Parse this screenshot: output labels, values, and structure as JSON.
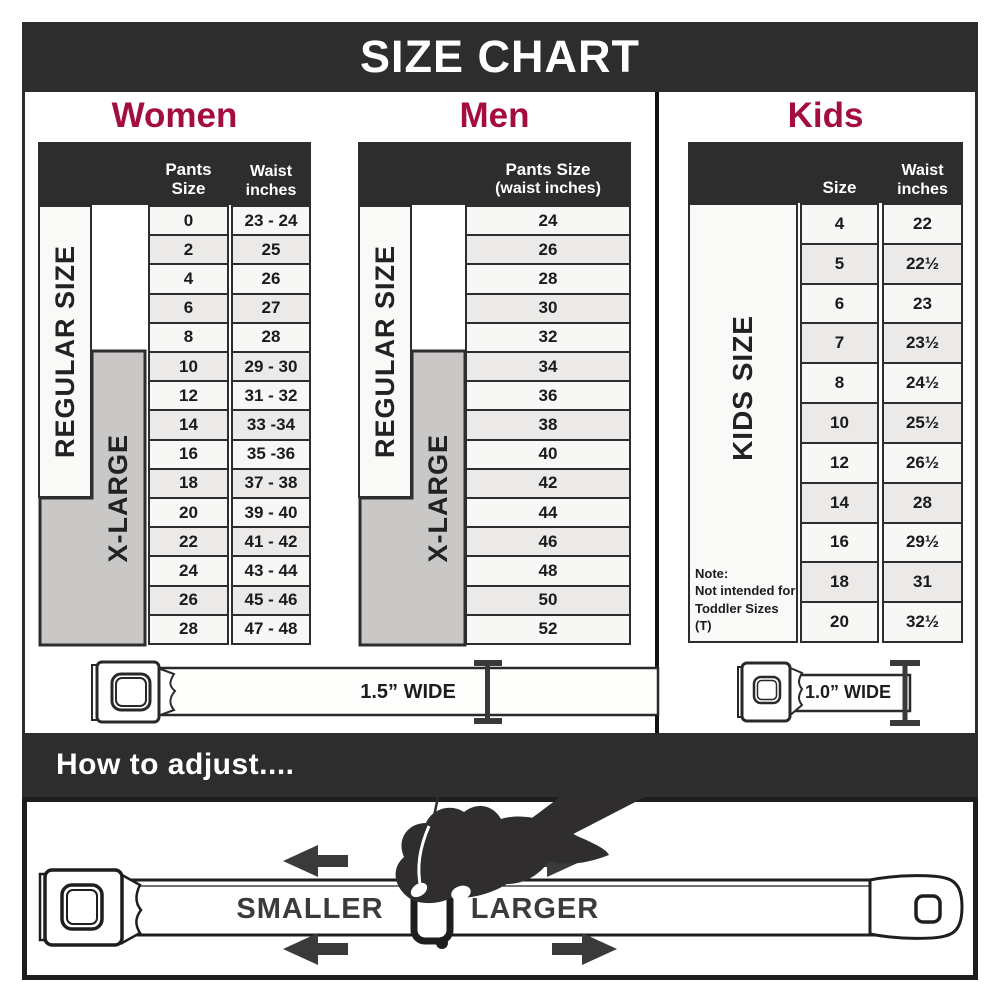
{
  "title": "SIZE CHART",
  "colors": {
    "dark": "#2e2d2e",
    "accent_crimson": "#a40e3e",
    "row_light": "#f7f7f5",
    "row_alt": "#eceae8",
    "xlarge_gray": "#c9c8c6"
  },
  "women": {
    "heading": "Women",
    "col1_header": "Pants Size",
    "col2_header_line1": "Waist",
    "col2_header_line2": "inches",
    "regular_label": "REGULAR SIZE",
    "xlarge_label": "X-LARGE",
    "rows": [
      {
        "size": "0",
        "waist": "23 - 24"
      },
      {
        "size": "2",
        "waist": "25"
      },
      {
        "size": "4",
        "waist": "26"
      },
      {
        "size": "6",
        "waist": "27"
      },
      {
        "size": "8",
        "waist": "28"
      },
      {
        "size": "10",
        "waist": "29 - 30"
      },
      {
        "size": "12",
        "waist": "31 - 32"
      },
      {
        "size": "14",
        "waist": "33 -34"
      },
      {
        "size": "16",
        "waist": "35 -36"
      },
      {
        "size": "18",
        "waist": "37 - 38"
      },
      {
        "size": "20",
        "waist": "39 - 40"
      },
      {
        "size": "22",
        "waist": "41 - 42"
      },
      {
        "size": "24",
        "waist": "43 - 44"
      },
      {
        "size": "26",
        "waist": "45 - 46"
      },
      {
        "size": "28",
        "waist": "47 - 48"
      }
    ]
  },
  "men": {
    "heading": "Men",
    "header_line1": "Pants Size",
    "header_line2": "(waist inches)",
    "regular_label": "REGULAR SIZE",
    "xlarge_label": "X-LARGE",
    "rows": [
      "24",
      "26",
      "28",
      "30",
      "32",
      "34",
      "36",
      "38",
      "40",
      "42",
      "44",
      "46",
      "48",
      "50",
      "52"
    ]
  },
  "kids": {
    "heading": "Kids",
    "col1_header": "Size",
    "col2_header_line1": "Waist",
    "col2_header_line2": "inches",
    "side_label": "KIDS SIZE",
    "note_line1": "Note:",
    "note_line2": "Not intended for",
    "note_line3": "Toddler Sizes (T)",
    "rows": [
      {
        "size": "4",
        "waist": "22"
      },
      {
        "size": "5",
        "waist": "22½"
      },
      {
        "size": "6",
        "waist": "23"
      },
      {
        "size": "7",
        "waist": "23½"
      },
      {
        "size": "8",
        "waist": "24½"
      },
      {
        "size": "10",
        "waist": "25½"
      },
      {
        "size": "12",
        "waist": "26½"
      },
      {
        "size": "14",
        "waist": "28"
      },
      {
        "size": "16",
        "waist": "29½"
      },
      {
        "size": "18",
        "waist": "31"
      },
      {
        "size": "20",
        "waist": "32½"
      }
    ]
  },
  "belts": {
    "adult_width_label": "1.5” WIDE",
    "kids_width_label": "1.0” WIDE"
  },
  "adjust": {
    "heading": "How to adjust....",
    "smaller_label": "SMALLER",
    "larger_label": "LARGER"
  }
}
